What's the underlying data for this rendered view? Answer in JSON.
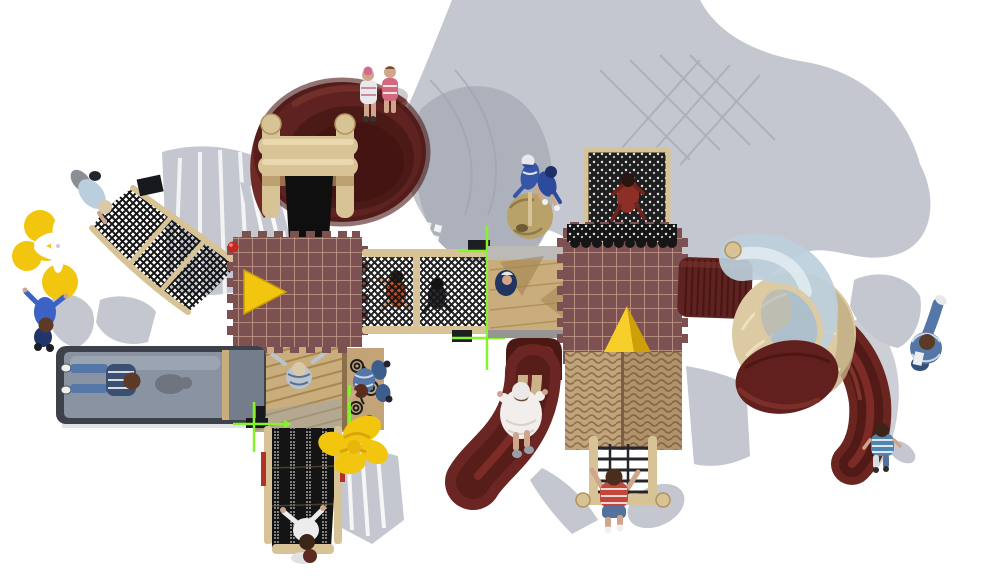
{
  "meta": {
    "description": "Top-down aerial 3D render of a children's playground play-structure on a white background with soft gray cast shadows",
    "view": "top-down"
  },
  "colors": {
    "bg": "#ffffff",
    "shadow": "#c4c7cf",
    "shadowDark": "#a8adb8",
    "shadowLine": "#9fa4b0",
    "maroon": "#5e2320",
    "maroonDeep": "#441511",
    "maroonMid": "#6f2a25",
    "roof": "#7d5051",
    "roofLine": "#cba693",
    "tan": "#d8c396",
    "tanDark": "#b2935f",
    "deck": "#c9ad7c",
    "deckLine": "#a8874f",
    "thatch": "#c2a47b",
    "thatchLine": "#8f7350",
    "black": "#161616",
    "mesh": "#141414",
    "graySlide": "#8a93a2",
    "graySlideDark": "#3d414a",
    "graySlideLight": "#a2abb8",
    "blueTube": "#bccfdc",
    "blueTubeLight": "#e3edf3",
    "cream": "#dccaa3",
    "creamShade": "#c2ad83",
    "yellow": "#f2c60f",
    "yellowDark": "#cf9f08",
    "lime": "#86f32c",
    "red": "#c5281c",
    "skin": "#cfa68b",
    "denim": "#5577a8",
    "denimDark": "#35507a",
    "navy": "#22356b",
    "blue": "#3b62c4",
    "lightBlue": "#b9cfdd",
    "redShirt": "#c4453a",
    "hair": "#4a2d1c",
    "blond": "#d9c9a8",
    "white": "#f0f0f0"
  },
  "scene": {
    "structures": [
      {
        "name": "spiral-dish-slide",
        "desc": "large maroon bowl slide, top left, two children seated on rim"
      },
      {
        "name": "roller-climber",
        "desc": "tan roller ladder with black ramp below the dish"
      },
      {
        "name": "left-climbing-net",
        "desc": "curved black rope net with tan rails, left side"
      },
      {
        "name": "flower-decoration-left",
        "desc": "yellow and white flower pinwheel at left edge"
      },
      {
        "name": "left-grid-roof",
        "desc": "maroon crenellated grid roof with yellow arrow marker and red ball"
      },
      {
        "name": "rope-bridge",
        "desc": "horizontal net tunnel with two children crawling inside"
      },
      {
        "name": "alignment-markers",
        "desc": "lime green crosshair guides at bridge end and slide corner"
      },
      {
        "name": "center-deck",
        "desc": "tan deck with child, between bridge and main roof"
      },
      {
        "name": "dome-climber",
        "desc": "tan dome with two children in blue on top"
      },
      {
        "name": "top-climbing-net-panel",
        "desc": "black lace net panel with climbing child in dark red"
      },
      {
        "name": "main-grid-roof",
        "desc": "large maroon crenellated grid roof with yellow 3D pyramid"
      },
      {
        "name": "spiral-tube-slide",
        "desc": "ribbed maroon tube, clear blue elbow, cream dome shell, maroon shell, curved maroon exit chute"
      },
      {
        "name": "thatched-roof",
        "desc": "two-panel straw thatch roof"
      },
      {
        "name": "rope-ladder",
        "desc": "climbing grid under thatch roof with boy in red climbing"
      },
      {
        "name": "gray-double-slide",
        "desc": "wide blue-gray slide, bottom left, two children sliding"
      },
      {
        "name": "lower-deck",
        "desc": "tan plank deck with child raising arms"
      },
      {
        "name": "scroll-panel",
        "desc": "tan panel with black spiral scrollwork and seated child"
      },
      {
        "name": "climbing-wall",
        "desc": "black perforated climbing wall with tan rails and red grips"
      },
      {
        "name": "flower-decoration-bottom",
        "desc": "large yellow flower beside climbing wall"
      },
      {
        "name": "tunnel-entrance",
        "desc": "dark maroon arch above the wave slide"
      },
      {
        "name": "wave-slide",
        "desc": "maroon S-curve slide with girl in white dress"
      }
    ],
    "people": [
      "children-on-dish-rim",
      "adult-on-climbing-net",
      "adult-walking-left",
      "children-in-rope-bridge",
      "children-on-dome",
      "child-on-net-panel",
      "child-on-center-deck",
      "children-on-gray-slide",
      "child-arms-up-deck",
      "child-on-scroll-panel",
      "children-at-wall-base",
      "girl-on-wave-slide",
      "boy-on-rope-ladder",
      "child-bottom-right",
      "adult-right-edge"
    ]
  }
}
